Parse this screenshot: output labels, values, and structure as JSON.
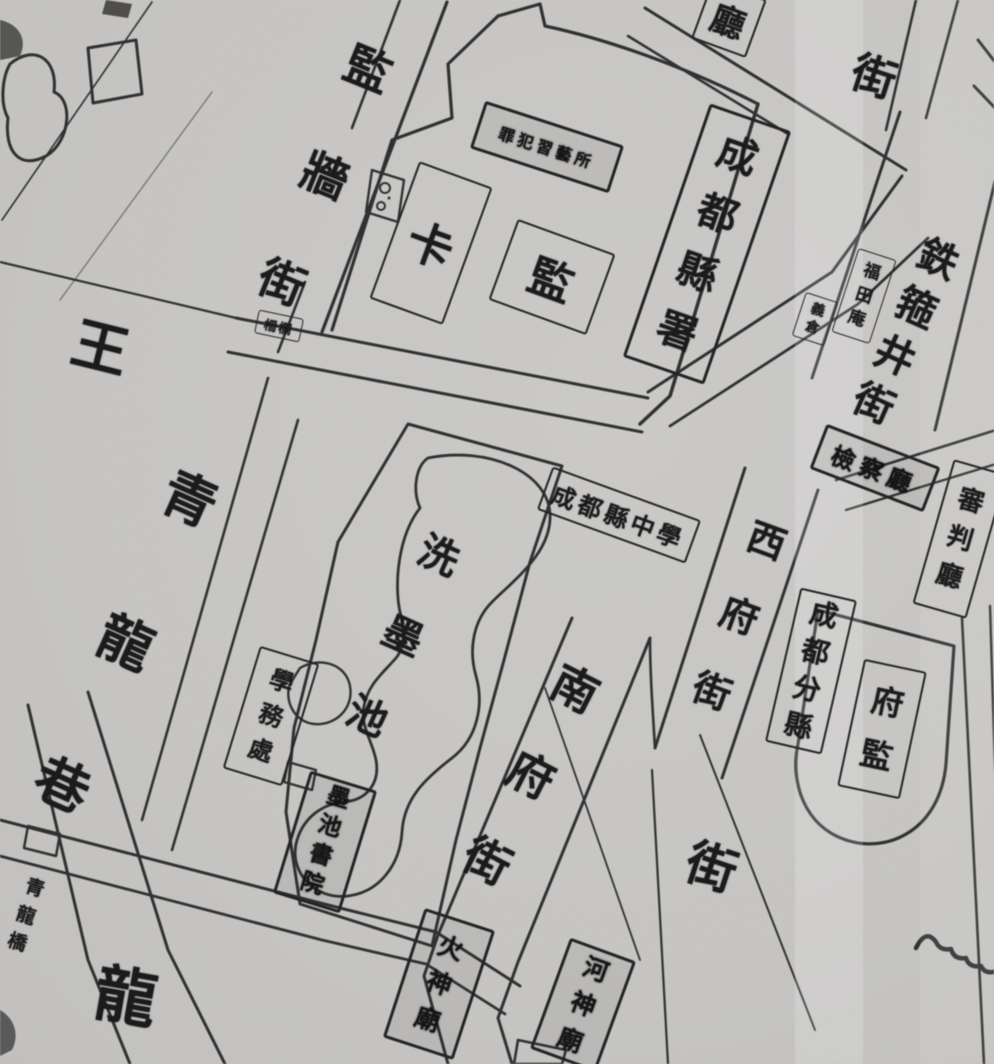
{
  "map": {
    "kind": "scanned historical street map (monochrome woodblock style)",
    "colors": {
      "paper": "#c7c6c4",
      "ink": "#1f1f1f"
    },
    "labels": {
      "jianqiang_street": {
        "text": "監牆街"
      },
      "wang": {
        "text": "王"
      },
      "qinglong_lane": {
        "text": "青龍巷"
      },
      "long_south": {
        "text": "龍"
      },
      "qinglong_bridge": {
        "text": "青龍橋"
      },
      "zhalan_gate": {
        "text": "柵欄"
      },
      "ka": {
        "text": "卡"
      },
      "jian": {
        "text": "監"
      },
      "xiyisuo": {
        "text": "罪犯習藝所"
      },
      "chengdu_xianshu": {
        "text": "成都縣署"
      },
      "ting_partial": {
        "text": "廳"
      },
      "jie_northeast": {
        "text": "街"
      },
      "tiegujing_street": {
        "text": "鉄箍井街"
      },
      "futian_temple": {
        "text": "福田庵"
      },
      "yicang": {
        "text": "義倉"
      },
      "shenpan_ting": {
        "text": "審判廳"
      },
      "jiancha_ting": {
        "text": "檢察廳"
      },
      "xifu_street": {
        "text": "西府街"
      },
      "chengdu_fenxian": {
        "text": "成都分縣"
      },
      "fu_jian": {
        "text": "府監"
      },
      "ximochi_pond": {
        "text": "洗墨池"
      },
      "xian_zhongxue": {
        "text": "成都縣中學"
      },
      "xuewuchu": {
        "text": "學務處"
      },
      "mochi_shuyuan": {
        "text": "墨池書院"
      },
      "nanfu_street": {
        "text": "南府街"
      },
      "jie_south": {
        "text": "街"
      },
      "huoshen_temple": {
        "text": "火神廟"
      },
      "heshen_temple": {
        "text": "河神廟"
      }
    },
    "features": {
      "pond": "irregular ink-wash pond outline (洗墨池)",
      "wells": "double well circles beside jail wall street",
      "gate_marker": "small rectangular street-gate on south-west street",
      "arch": "horseshoe-walled prefectural jail compound (府監)"
    }
  }
}
